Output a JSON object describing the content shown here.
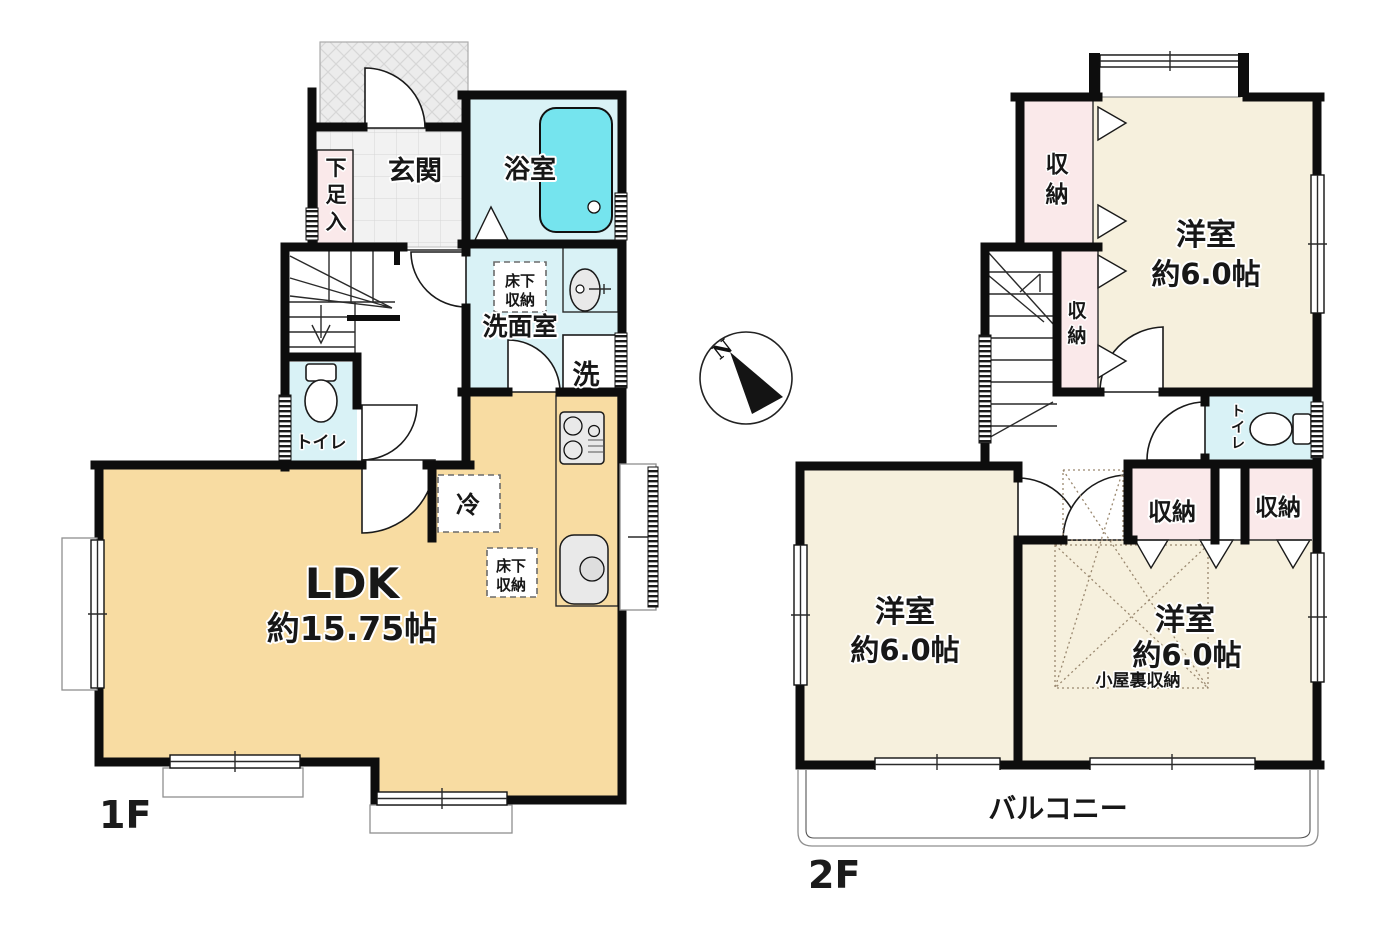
{
  "palette": {
    "wall": "#0d0d0d",
    "ldk_floor": "#f8dca2",
    "room_floor": "#f6f0dd",
    "water": "#d9f2f6",
    "tub": "#75e4ee",
    "closet": "#fae9ea",
    "tile": "#f2f2f2",
    "porch": "#ececec"
  },
  "floor1": {
    "label": "1F",
    "genkan": "玄関",
    "shoe_box": "下足入",
    "bath": "浴室",
    "washroom": "洗面室",
    "underfloor1": {
      "line1": "床下",
      "line2": "収納"
    },
    "washer": "洗",
    "toilet": "トイレ",
    "ldk": {
      "name": "LDK",
      "size": "約15.75帖"
    },
    "fridge": "冷",
    "underfloor2": {
      "line1": "床下",
      "line2": "収納"
    }
  },
  "floor2": {
    "label": "2F",
    "room_north": {
      "name": "洋室",
      "size": "約6.0帖"
    },
    "room_sw": {
      "name": "洋室",
      "size": "約6.0帖"
    },
    "room_se": {
      "name": "洋室",
      "size": "約6.0帖"
    },
    "closets": {
      "nw": "収納",
      "mid": "収納",
      "s1": "収納",
      "s2": "収納"
    },
    "toilet": "トイレ",
    "attic_storage": "小屋裏収納",
    "balcony": "バルコニー"
  },
  "compass": {
    "north": "N"
  }
}
